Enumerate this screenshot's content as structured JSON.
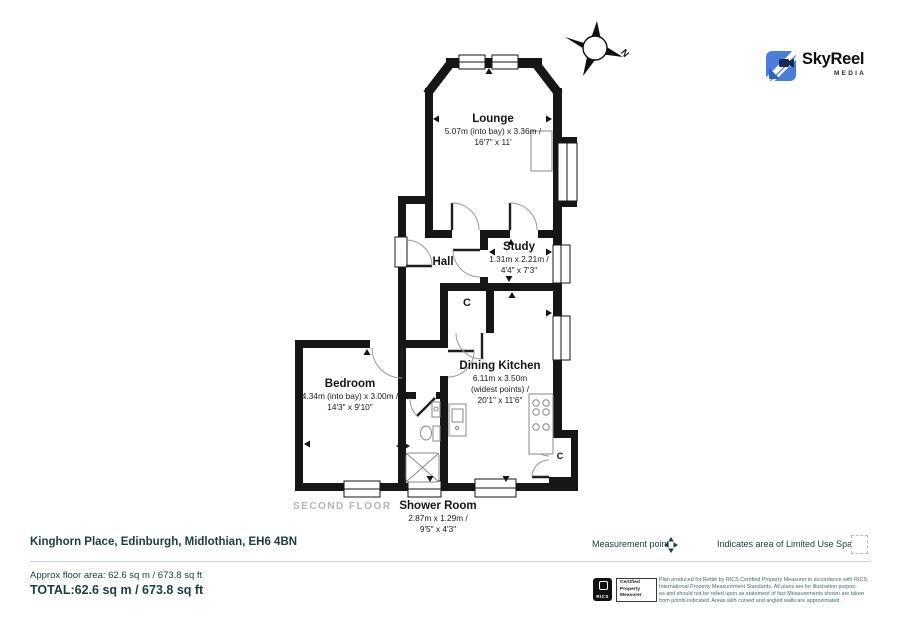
{
  "branding": {
    "logo_text": "SkyReel",
    "logo_sub": "MEDIA",
    "logo_color": "#4a7ed8"
  },
  "compass": {
    "north_label": "N"
  },
  "plan": {
    "floor_label": "SECOND FLOOR",
    "rooms": [
      {
        "name": "Lounge",
        "dims": [
          "5.07m (into bay) x 3.36m /",
          "16'7\" x 11'"
        ]
      },
      {
        "name": "Hall",
        "dims": []
      },
      {
        "name": "Study",
        "dims": [
          "1.31m x 2.21m /",
          "4'4\" x 7'3\""
        ]
      },
      {
        "name": "Dining Kitchen",
        "dims": [
          "6.11m x 3.50m",
          "(widest points) /",
          "20'1\" x 11'6\""
        ]
      },
      {
        "name": "Bedroom",
        "dims": [
          "4.34m (into bay) x 3.00m /",
          "14'3\" x 9'10\""
        ]
      },
      {
        "name": "Shower Room",
        "dims": [
          "2.87m x 1.29m /",
          "9'5\" x 4'3\""
        ]
      },
      {
        "name": "C"
      },
      {
        "name": "C"
      }
    ]
  },
  "footer": {
    "address": "Kinghorn Place, Edinburgh, Midlothian, EH6 4BN",
    "legend_measurement": "Measurement point",
    "legend_limited": "Indicates area of  Limited Use Space",
    "approx_area": "Approx floor area: 62.6 sq m / 673.8 sq ft",
    "total": "TOTAL:62.6 sq m / 673.8 sq ft",
    "cert": {
      "org": "RICS",
      "lines": [
        "Certified",
        "Property",
        "Measurer"
      ]
    },
    "disclaimer": [
      "Plan produced for Rettie by RICS Certified Property Measurer in accordance with RICS",
      "International Property  Measurement Standards.  All plans are for illustration purpos-",
      "es and should not be relied upon as statement of fact Measurements shown are taken",
      "from points indicated. Areas with curved and angled walls are approximated."
    ]
  },
  "colors": {
    "wall": "#161616",
    "teal": "#1d3c40",
    "muted": "#b5b5b5",
    "logo_blue": "#4a7ed8"
  }
}
